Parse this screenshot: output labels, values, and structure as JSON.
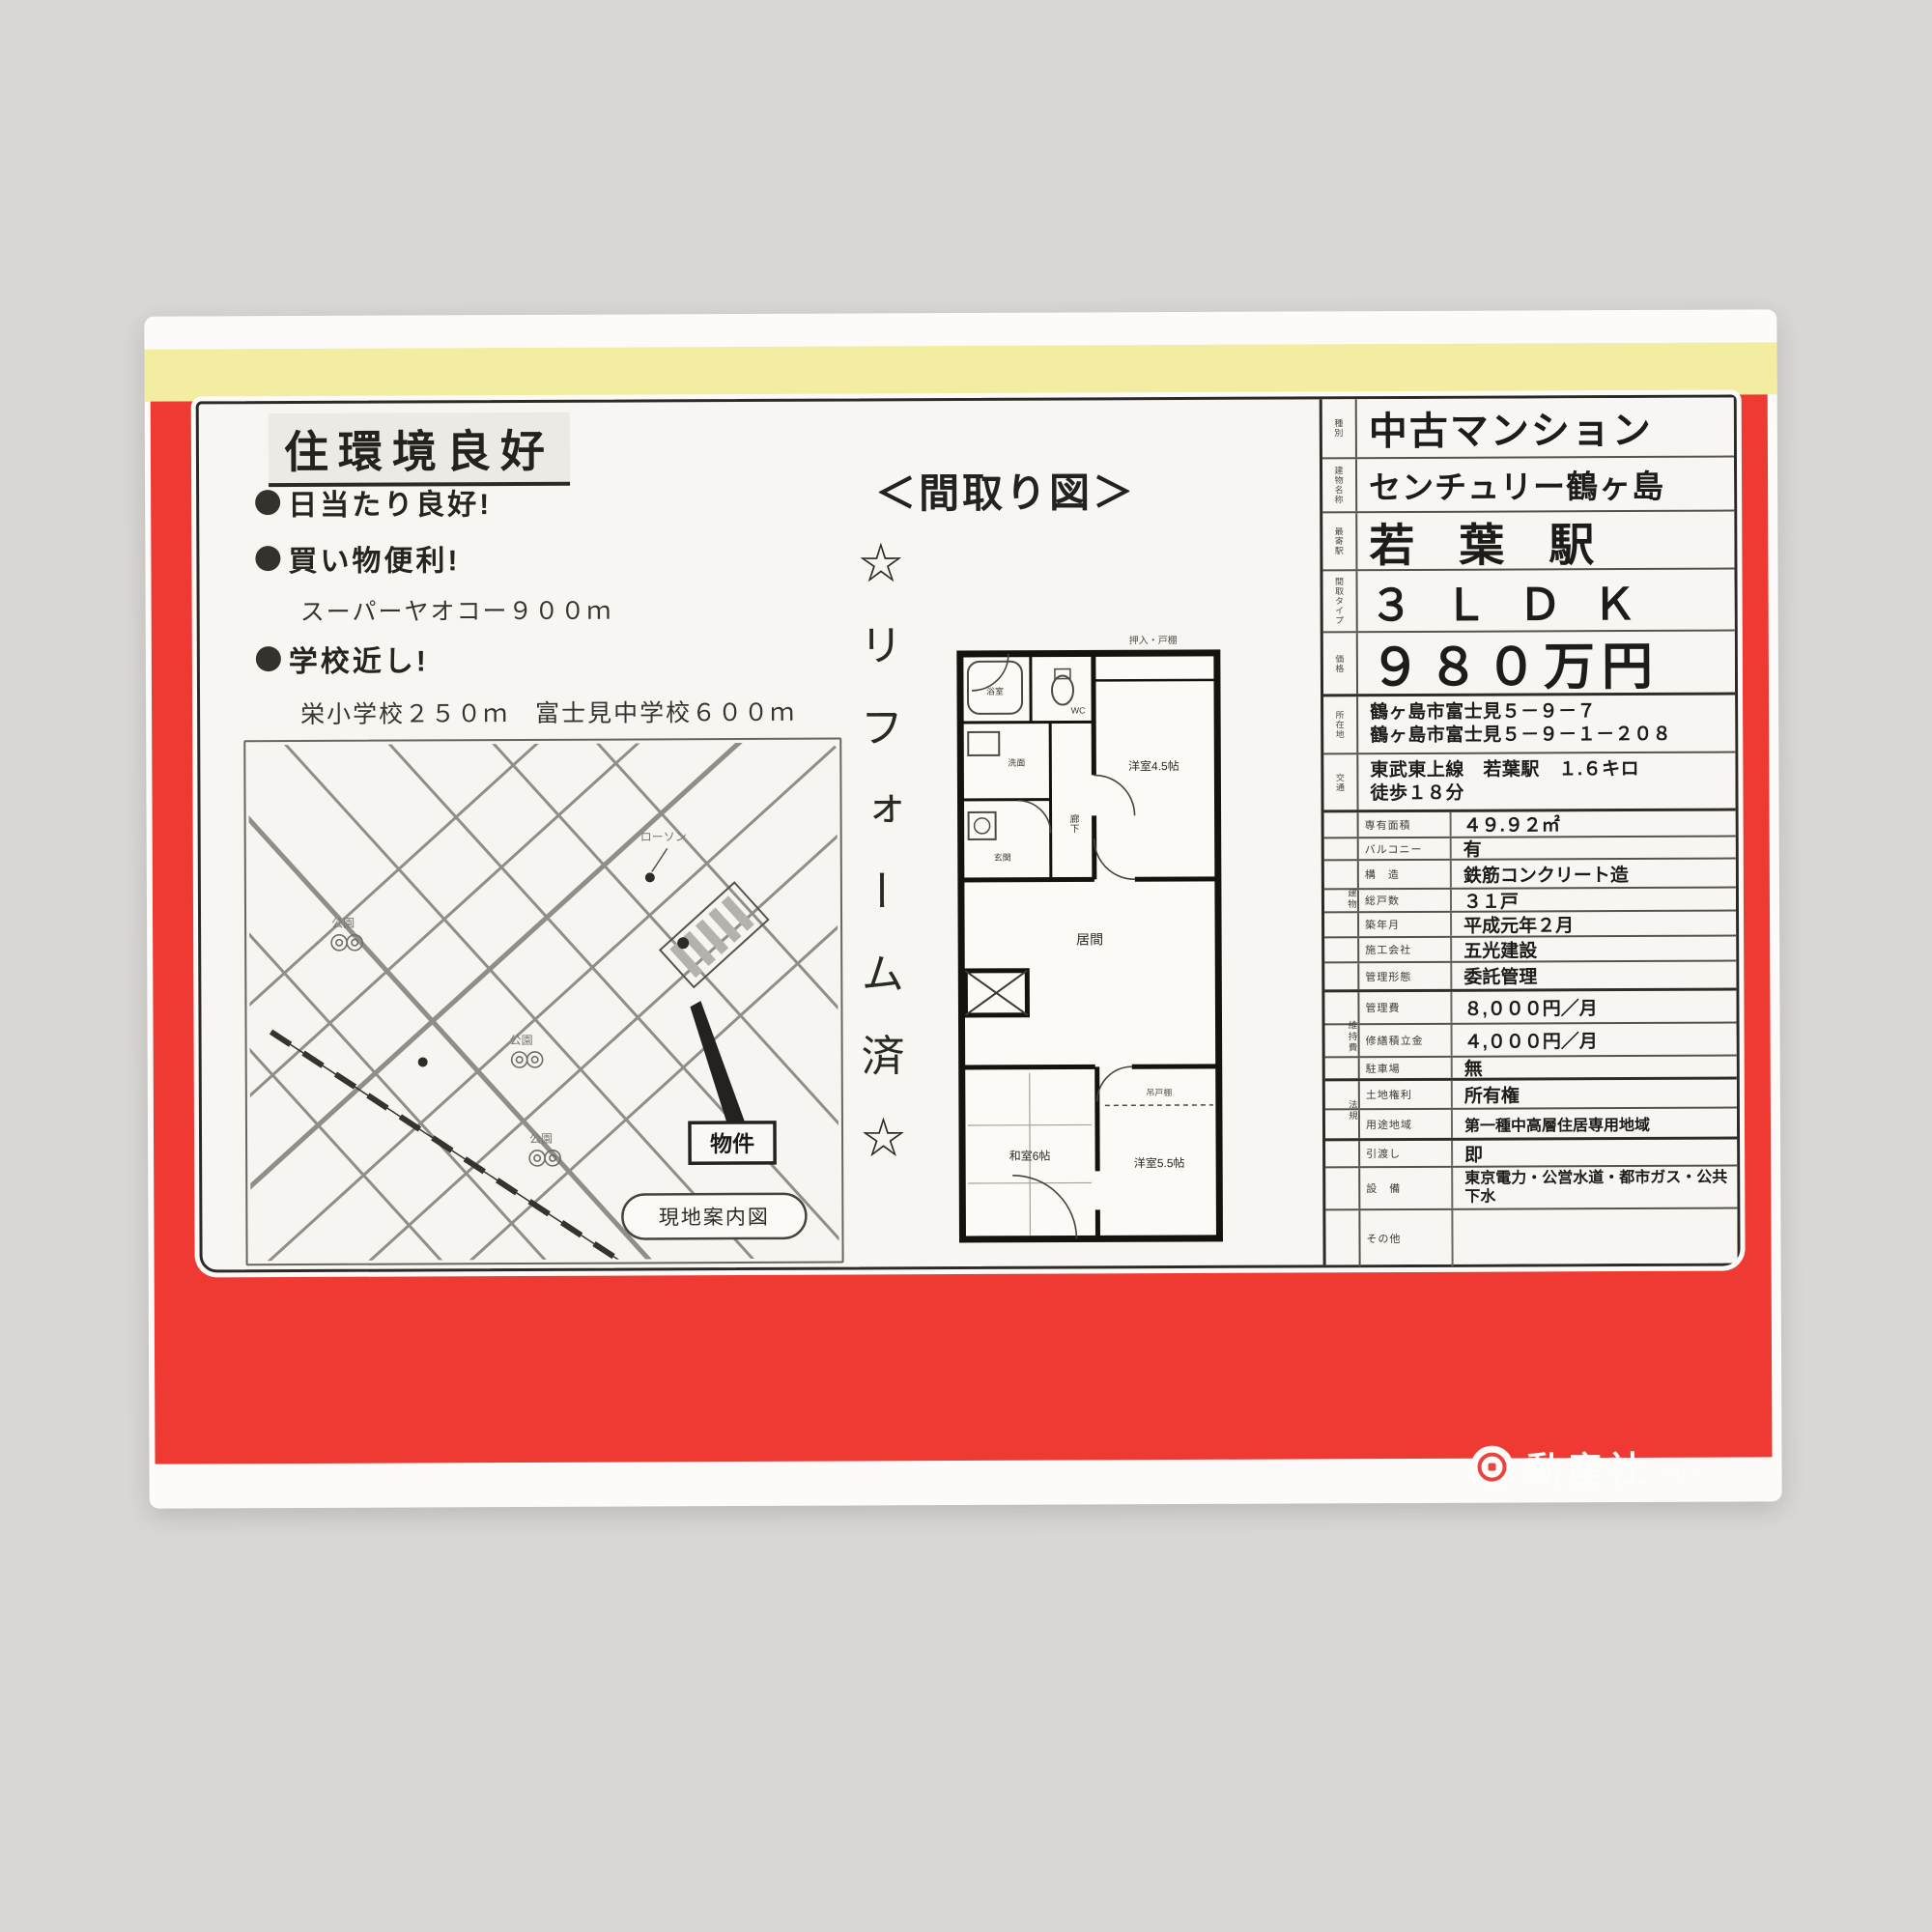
{
  "colors": {
    "flyer_red": "#ee3a33",
    "band_yellow": "#f2eda1",
    "paper": "#f7f6f3",
    "ink": "#23221f"
  },
  "left": {
    "headline": "住環境良好",
    "bullets": [
      {
        "text": "日当たり良好!"
      },
      {
        "text": "買い物便利!",
        "sub": "スーパーヤオコー９００ｍ"
      },
      {
        "text": "学校近し!",
        "sub": "栄小学校２５０ｍ　富士見中学校６００ｍ"
      }
    ],
    "map": {
      "caption": "現地案内図",
      "property": "物件",
      "store": "ローソン",
      "parks": [
        "公園",
        "公園",
        "公園"
      ]
    }
  },
  "middle": {
    "title": "＜間取り図＞",
    "reform": "☆リフォーム済☆",
    "floorplan": {
      "top_note": "押入・戸棚",
      "bath": "浴室",
      "wc": "WC",
      "wash": "洗面",
      "entry": "玄関",
      "hall": "廊下",
      "bed1": "洋室4.5帖",
      "living": "居間",
      "tatami": "和室6帖",
      "bed2": "洋室5.5帖",
      "shelf": "吊戸棚"
    }
  },
  "right_table": {
    "rows_top": [
      {
        "label": "種別",
        "value": "中古マンション"
      },
      {
        "label": "建物名称",
        "value": "センチュリー鶴ヶ島"
      },
      {
        "label": "最寄駅",
        "value": "若葉駅"
      },
      {
        "label": "間取タイプ",
        "value": "３ＬＤＫ"
      },
      {
        "label": "価格",
        "value": "９８０万円"
      },
      {
        "label": "所在地",
        "value1": "鶴ヶ島市富士見５－９－７",
        "value2": "鶴ヶ島市富士見５－９－１－２０８"
      },
      {
        "label": "交通",
        "value1": "東武東上線　若葉駅　１.６キロ",
        "value2": "徒歩１８分"
      }
    ],
    "groups": [
      "建物",
      "維持費",
      "法規"
    ],
    "rows_detail": [
      {
        "label": "専有面積",
        "value": "４９.９２㎡"
      },
      {
        "label": "バルコニー",
        "value": "有"
      },
      {
        "label": "構　造",
        "value": "鉄筋コンクリート造"
      },
      {
        "label": "総戸数",
        "value": "３１戸"
      },
      {
        "label": "築年月",
        "value": "平成元年２月"
      },
      {
        "label": "施工会社",
        "value": "五光建設"
      },
      {
        "label": "管理形態",
        "value": "委託管理"
      },
      {
        "label": "管理費",
        "value": "８,０００円／月"
      },
      {
        "label": "修繕積立金",
        "value": "４,０００円／月"
      },
      {
        "label": "駐車場",
        "value": "無"
      },
      {
        "label": "土地権利",
        "value": "所有権"
      },
      {
        "label": "用途地域",
        "value": "第一種中高層住居専用地域"
      },
      {
        "label": "引渡し",
        "value": "即"
      },
      {
        "label": "設　備",
        "value": "東京電力・公営水道・都市ガス・公共下水"
      },
      {
        "label": "その他",
        "value": ""
      }
    ]
  },
  "footer": {
    "company": "動産社",
    "note": "NO.3"
  }
}
